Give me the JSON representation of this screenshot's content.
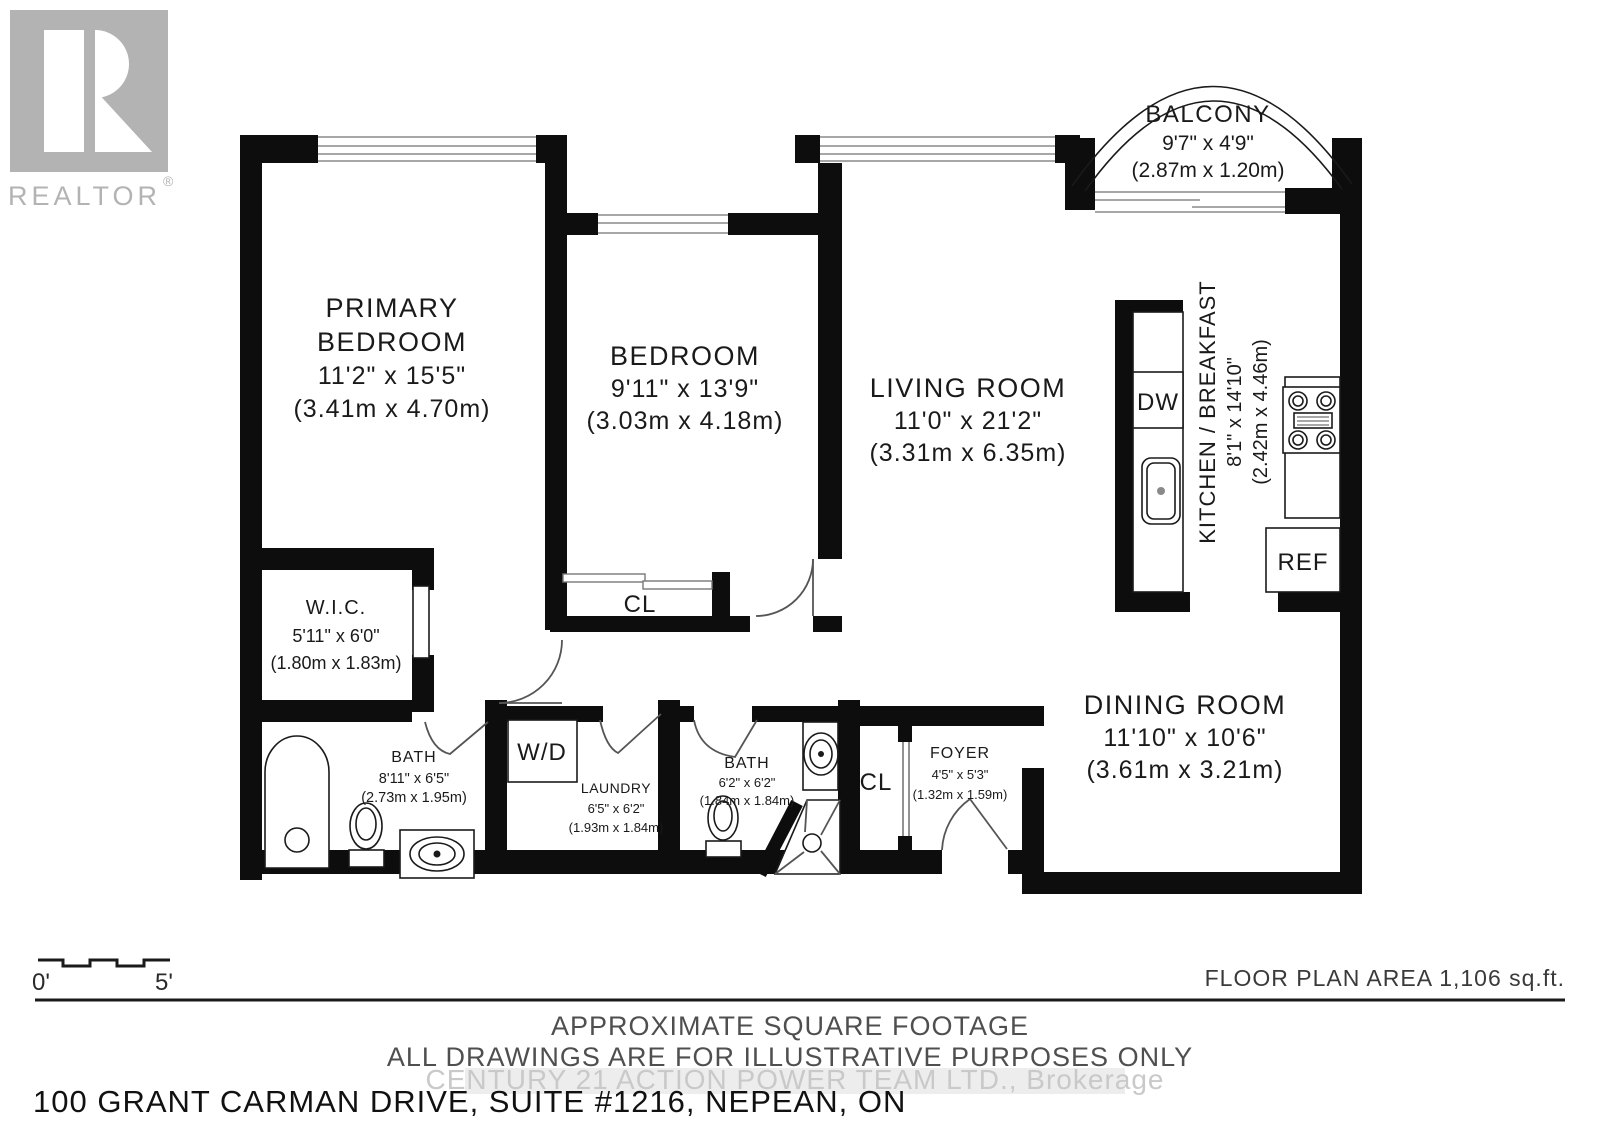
{
  "branding": {
    "realtor_text": "REALTOR",
    "registered": "®"
  },
  "rooms": {
    "balcony": {
      "name": "BALCONY",
      "imperial": "9'7\" x 4'9\"",
      "metric": "(2.87m x 1.20m)"
    },
    "primary_bedroom": {
      "name_line1": "PRIMARY",
      "name_line2": "BEDROOM",
      "imperial": "11'2\" x 15'5\"",
      "metric": "(3.41m x 4.70m)"
    },
    "bedroom": {
      "name": "BEDROOM",
      "imperial": "9'11\" x 13'9\"",
      "metric": "(3.03m x 4.18m)"
    },
    "living_room": {
      "name": "LIVING ROOM",
      "imperial": "11'0\" x 21'2\"",
      "metric": "(3.31m x 6.35m)"
    },
    "kitchen": {
      "name": "KITCHEN / BREAKFAST",
      "imperial": "8'1\" x 14'10\"",
      "metric": "(2.42m x 4.46m)"
    },
    "wic": {
      "name": "W.I.C.",
      "imperial": "5'11\" x 6'0\"",
      "metric": "(1.80m x 1.83m)"
    },
    "bath_ensuite": {
      "name": "BATH",
      "imperial": "8'11\" x 6'5\"",
      "metric": "(2.73m x 1.95m)"
    },
    "laundry": {
      "name": "LAUNDRY",
      "imperial": "6'5\" x 6'2\"",
      "metric": "(1.93m x 1.84m)"
    },
    "bath_main": {
      "name": "BATH",
      "imperial": "6'2\" x 6'2\"",
      "metric": "(1.84m x 1.84m)"
    },
    "foyer": {
      "name": "FOYER",
      "imperial": "4'5\" x 5'3\"",
      "metric": "(1.32m x 1.59m)"
    },
    "dining_room": {
      "name": "DINING ROOM",
      "imperial": "11'10\" x 10'6\"",
      "metric": "(3.61m x 3.21m)"
    }
  },
  "fixture_labels": {
    "dishwasher": "DW",
    "refrigerator": "REF",
    "washer_dryer": "W/D",
    "foyer_closet": "CL",
    "bedroom_closet": "CL"
  },
  "scale_bar": {
    "start_label": "0'",
    "end_label": "5'"
  },
  "footer": {
    "floor_plan_area": "FLOOR PLAN AREA 1,106 sq.ft.",
    "disclaimer_line1": "APPROXIMATE SQUARE FOOTAGE",
    "disclaimer_line2": "ALL DRAWINGS ARE FOR ILLUSTRATIVE PURPOSES ONLY",
    "watermark": "CENTURY 21 ACTION POWER TEAM LTD., Brokerage",
    "address": "100 GRANT CARMAN DRIVE, SUITE #1216, NEPEAN, ON"
  },
  "colors": {
    "wall": "#0d0d0d",
    "logo_gray": "#b3b3b3",
    "watermark_gray": "#c9c9c9",
    "disclaimer_gray": "#4f4f4f"
  }
}
